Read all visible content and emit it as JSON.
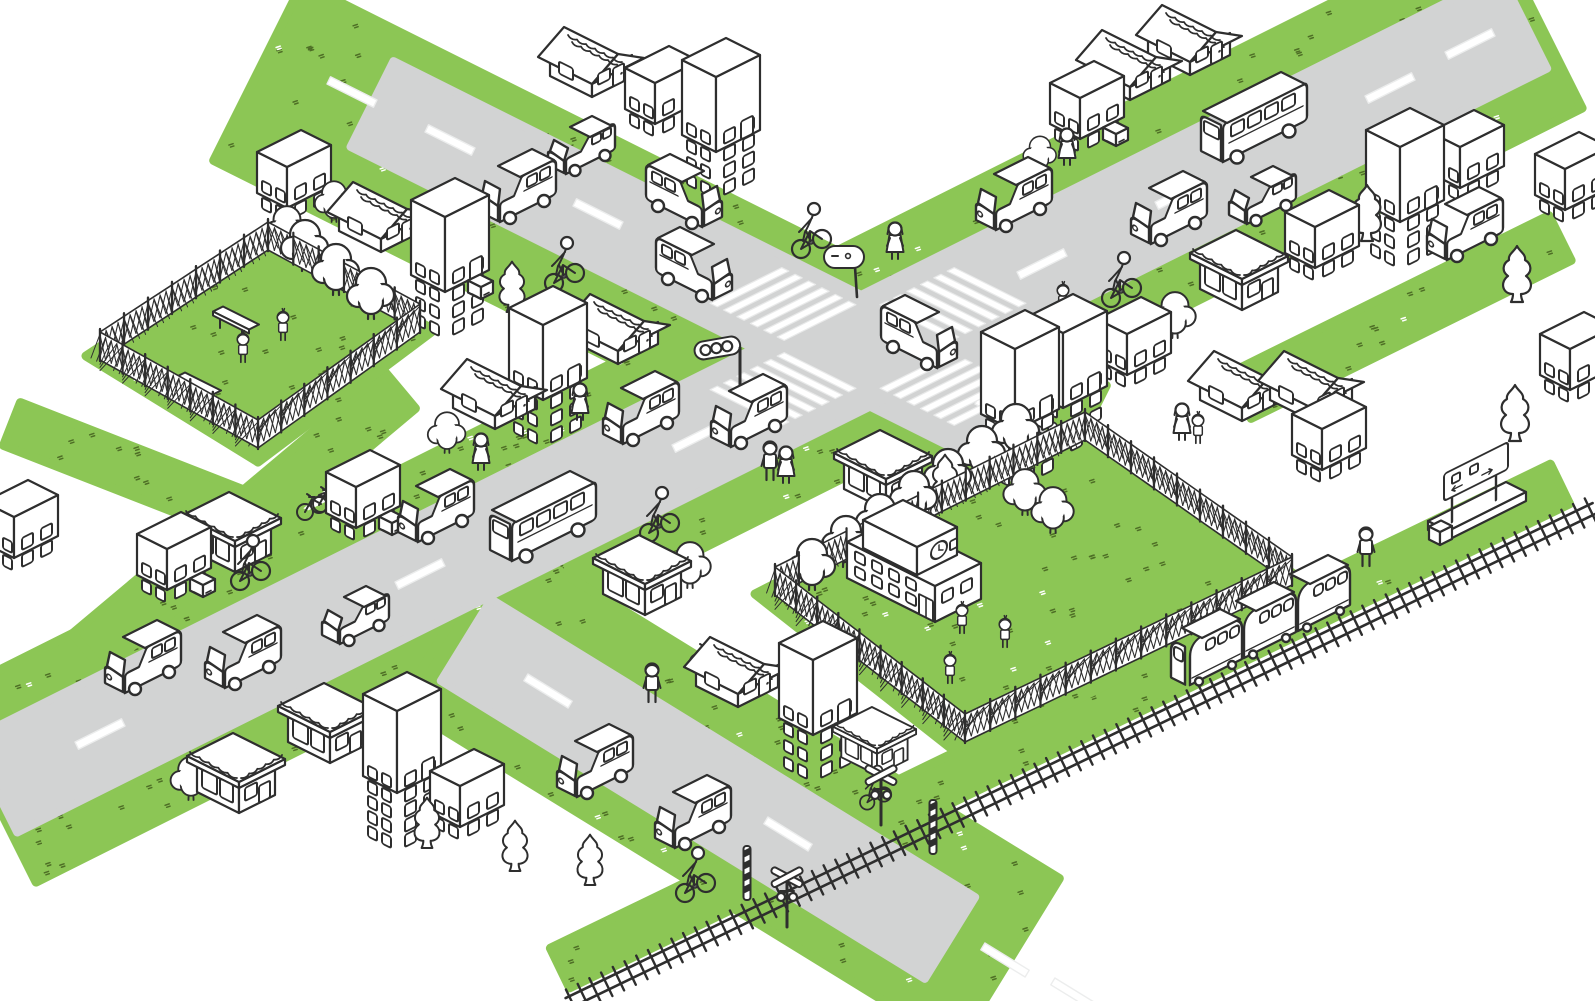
{
  "title": "isometric-town-illustration",
  "canvas": {
    "width": 1595,
    "height": 1001
  },
  "colors": {
    "grass": "#8cc655",
    "grass_speckle": "#4e6e26",
    "road": "#d2d3d3",
    "ink": "#2e2e2e",
    "white": "#ffffff"
  },
  "greens": [
    {
      "kind": "band",
      "name": "verge-road-nw",
      "from": [
        258,
        72
      ],
      "to": [
        1062,
        474
      ],
      "w": 198
    },
    {
      "kind": "band",
      "name": "verge-road-ne",
      "from": [
        1536,
        16
      ],
      "to": [
        -10,
        790
      ],
      "w": 206
    },
    {
      "kind": "band",
      "name": "verge-road-south",
      "from": [
        452,
        620
      ],
      "to": [
        1008,
        962
      ],
      "w": 196
    },
    {
      "kind": "band",
      "name": "sidewalk-strip-1",
      "from": [
        12,
        424
      ],
      "to": [
        452,
        596
      ],
      "w": 46
    },
    {
      "kind": "band",
      "name": "sidewalk-strip-2",
      "from": [
        88,
        652
      ],
      "to": [
        400,
        390
      ],
      "w": 48
    },
    {
      "kind": "band",
      "name": "sidewalk-strip-3",
      "from": [
        1240,
        396
      ],
      "to": [
        1560,
        238
      ],
      "w": 50
    },
    {
      "kind": "band",
      "name": "railway-verge",
      "from": [
        560,
        968
      ],
      "to": [
        1560,
        484
      ],
      "w": 44
    },
    {
      "kind": "poly",
      "name": "park-lawn",
      "pts": [
        [
          268,
          236
        ],
        [
          434,
          330
        ],
        [
          258,
          462
        ],
        [
          86,
          356
        ]
      ]
    },
    {
      "kind": "poly",
      "name": "schoolyard-lawn",
      "pts": [
        [
          1082,
          426
        ],
        [
          1308,
          584
        ],
        [
          962,
          757
        ],
        [
          755,
          594
        ]
      ]
    }
  ],
  "roads": [
    {
      "name": "road-northwest",
      "from": [
        372,
        104
      ],
      "to": [
        1038,
        437
      ],
      "w": 96
    },
    {
      "name": "road-northeast",
      "from": [
        1524,
        22
      ],
      "to": [
        -6,
        786
      ],
      "w": 104
    },
    {
      "name": "road-south",
      "from": [
        466,
        640
      ],
      "to": [
        950,
        938
      ],
      "w": 96
    }
  ],
  "dashes": [
    {
      "x": 352,
      "y": 92,
      "a": "u"
    },
    {
      "x": 450,
      "y": 140,
      "a": "u"
    },
    {
      "x": 598,
      "y": 214,
      "a": "u"
    },
    {
      "x": 1000,
      "y": 412,
      "a": "u"
    },
    {
      "x": 1470,
      "y": 44,
      "a": "v"
    },
    {
      "x": 1390,
      "y": 88,
      "a": "v"
    },
    {
      "x": 1180,
      "y": 194,
      "a": "v"
    },
    {
      "x": 1042,
      "y": 264,
      "a": "v"
    },
    {
      "x": 697,
      "y": 437,
      "a": "v"
    },
    {
      "x": 420,
      "y": 574,
      "a": "v"
    },
    {
      "x": 100,
      "y": 734,
      "a": "v"
    },
    {
      "x": 548,
      "y": 691,
      "a": "c"
    },
    {
      "x": 788,
      "y": 834,
      "a": "c"
    },
    {
      "x": 1005,
      "y": 960,
      "a": "c"
    },
    {
      "x": 1075,
      "y": 995,
      "a": "c"
    }
  ],
  "crosswalks": [
    {
      "x": 783,
      "y": 304,
      "a": "a"
    },
    {
      "x": 953,
      "y": 389,
      "a": "a"
    },
    {
      "x": 953,
      "y": 304,
      "a": "b"
    },
    {
      "x": 783,
      "y": 389,
      "a": "b"
    }
  ],
  "railway": {
    "from": [
      568,
      1003
    ],
    "to": [
      1595,
      508
    ]
  },
  "fences": [
    {
      "name": "park-fence",
      "h": 28,
      "pts": [
        [
          268,
          250
        ],
        [
          420,
          332
        ],
        [
          258,
          448
        ],
        [
          100,
          360
        ]
      ]
    },
    {
      "name": "schoolyard-fence",
      "h": 28,
      "pts": [
        [
          1085,
          440
        ],
        [
          1292,
          585
        ],
        [
          965,
          742
        ],
        [
          775,
          595
        ]
      ]
    }
  ],
  "objects": [
    {
      "t": "minivan",
      "x": 517,
      "y": 226,
      "o": "sw"
    },
    {
      "t": "car",
      "x": 581,
      "y": 178,
      "o": "sw"
    },
    {
      "t": "minivan",
      "x": 685,
      "y": 231,
      "o": "se"
    },
    {
      "t": "minivan",
      "x": 695,
      "y": 304,
      "o": "se"
    },
    {
      "t": "minivan",
      "x": 920,
      "y": 372,
      "o": "se"
    },
    {
      "t": "minivan",
      "x": 1013,
      "y": 234,
      "o": "sw"
    },
    {
      "t": "minivan",
      "x": 1168,
      "y": 248,
      "o": "sw"
    },
    {
      "t": "car",
      "x": 1262,
      "y": 228,
      "o": "sw"
    },
    {
      "t": "bus",
      "x": 1253,
      "y": 166,
      "o": "sw"
    },
    {
      "t": "minivan",
      "x": 1464,
      "y": 264,
      "o": "sw"
    },
    {
      "t": "minivan",
      "x": 748,
      "y": 451,
      "o": "sw"
    },
    {
      "t": "minivan",
      "x": 640,
      "y": 448,
      "o": "sw"
    },
    {
      "t": "minivan",
      "x": 435,
      "y": 546,
      "o": "sw"
    },
    {
      "t": "bus",
      "x": 542,
      "y": 565,
      "o": "sw"
    },
    {
      "t": "car",
      "x": 355,
      "y": 648,
      "o": "sw"
    },
    {
      "t": "minivan",
      "x": 242,
      "y": 692,
      "o": "sw"
    },
    {
      "t": "minivan",
      "x": 142,
      "y": 697,
      "o": "sw"
    },
    {
      "t": "minivan",
      "x": 594,
      "y": 801,
      "o": "sw"
    },
    {
      "t": "minivan",
      "x": 692,
      "y": 852,
      "o": "sw"
    },
    {
      "t": "train",
      "x": 1205,
      "y": 690
    },
    {
      "t": "building",
      "x": 287,
      "y": 208,
      "f": 2
    },
    {
      "t": "house",
      "x": 381,
      "y": 252
    },
    {
      "t": "building",
      "x": 445,
      "y": 292,
      "f": 4,
      "box": true
    },
    {
      "t": "house",
      "x": 592,
      "y": 97
    },
    {
      "t": "building",
      "x": 655,
      "y": 124,
      "f": 2
    },
    {
      "t": "building",
      "x": 716,
      "y": 152,
      "f": 4
    },
    {
      "t": "building",
      "x": 543,
      "y": 400,
      "f": 4
    },
    {
      "t": "house",
      "x": 618,
      "y": 364
    },
    {
      "t": "house",
      "x": 495,
      "y": 429
    },
    {
      "t": "building",
      "x": 167,
      "y": 590,
      "f": 2,
      "box": true
    },
    {
      "t": "shop",
      "x": 235,
      "y": 572
    },
    {
      "t": "building",
      "x": 356,
      "y": 528,
      "f": 2,
      "box": true
    },
    {
      "t": "building",
      "x": 14,
      "y": 558,
      "f": 2
    },
    {
      "t": "shop",
      "x": 239,
      "y": 813
    },
    {
      "t": "shop",
      "x": 330,
      "y": 763
    },
    {
      "t": "building",
      "x": 397,
      "y": 793,
      "f": 5
    },
    {
      "t": "building",
      "x": 460,
      "y": 827,
      "f": 2
    },
    {
      "t": "shop",
      "x": 645,
      "y": 615
    },
    {
      "t": "house",
      "x": 738,
      "y": 707
    },
    {
      "t": "building",
      "x": 813,
      "y": 735,
      "f": 4
    },
    {
      "t": "shop",
      "x": 877,
      "y": 775,
      "s": 0.85
    },
    {
      "t": "shop",
      "x": 886,
      "y": 510,
      "box": true
    },
    {
      "t": "school",
      "x": 935,
      "y": 622
    },
    {
      "t": "building",
      "x": 1015,
      "y": 431,
      "f": 5
    },
    {
      "t": "building",
      "x": 1063,
      "y": 408,
      "f": 4
    },
    {
      "t": "building",
      "x": 1127,
      "y": 375,
      "f": 2
    },
    {
      "t": "shop",
      "x": 1242,
      "y": 310
    },
    {
      "t": "building",
      "x": 1315,
      "y": 268,
      "f": 2
    },
    {
      "t": "house",
      "x": 1242,
      "y": 421
    },
    {
      "t": "house",
      "x": 1312,
      "y": 421
    },
    {
      "t": "building",
      "x": 1322,
      "y": 470,
      "f": 2
    },
    {
      "t": "house",
      "x": 1130,
      "y": 100
    },
    {
      "t": "house",
      "x": 1190,
      "y": 75
    },
    {
      "t": "building",
      "x": 1080,
      "y": 139,
      "f": 2,
      "box": true
    },
    {
      "t": "building",
      "x": 1400,
      "y": 222,
      "f": 4
    },
    {
      "t": "building",
      "x": 1460,
      "y": 188,
      "f": 2
    },
    {
      "t": "building",
      "x": 1565,
      "y": 210,
      "f": 2
    },
    {
      "t": "building",
      "x": 1570,
      "y": 390,
      "f": 2
    },
    {
      "t": "round-tree",
      "x": 334,
      "y": 222,
      "s": 0.8
    },
    {
      "t": "conifer-tree",
      "x": 512,
      "y": 312,
      "s": 0.9
    },
    {
      "t": "round-tree",
      "x": 447,
      "y": 453,
      "s": 0.8
    },
    {
      "t": "round-tree",
      "x": 287,
      "y": 252,
      "s": 0.9
    },
    {
      "t": "round-tree",
      "x": 305,
      "y": 271
    },
    {
      "t": "round-tree",
      "x": 336,
      "y": 295
    },
    {
      "t": "round-tree",
      "x": 371,
      "y": 319
    },
    {
      "t": "round-tree",
      "x": 191,
      "y": 800,
      "s": 0.85
    },
    {
      "t": "conifer-tree",
      "x": 427,
      "y": 848,
      "s": 0.9
    },
    {
      "t": "conifer-tree",
      "x": 515,
      "y": 871,
      "s": 0.9
    },
    {
      "t": "conifer-tree",
      "x": 590,
      "y": 885,
      "s": 0.9
    },
    {
      "t": "round-tree",
      "x": 690,
      "y": 588,
      "s": 0.9
    },
    {
      "t": "conifer-tree",
      "x": 945,
      "y": 505,
      "s": 0.9
    },
    {
      "t": "round-tree",
      "x": 812,
      "y": 590
    },
    {
      "t": "round-tree",
      "x": 846,
      "y": 567
    },
    {
      "t": "round-tree",
      "x": 880,
      "y": 545
    },
    {
      "t": "round-tree",
      "x": 914,
      "y": 522
    },
    {
      "t": "round-tree",
      "x": 948,
      "y": 500
    },
    {
      "t": "round-tree",
      "x": 982,
      "y": 477
    },
    {
      "t": "round-tree",
      "x": 1016,
      "y": 455
    },
    {
      "t": "round-tree",
      "x": 1025,
      "y": 515,
      "s": 0.9
    },
    {
      "t": "round-tree",
      "x": 1053,
      "y": 533,
      "s": 0.9
    },
    {
      "t": "round-tree",
      "x": 1175,
      "y": 338,
      "s": 0.9
    },
    {
      "t": "conifer-tree",
      "x": 1367,
      "y": 241
    },
    {
      "t": "conifer-tree",
      "x": 1517,
      "y": 302
    },
    {
      "t": "conifer-tree",
      "x": 1515,
      "y": 441
    },
    {
      "t": "round-tree",
      "x": 1040,
      "y": 172,
      "s": 0.7
    },
    {
      "t": "woman",
      "x": 580,
      "y": 421
    },
    {
      "t": "woman",
      "x": 481,
      "y": 471
    },
    {
      "t": "woman",
      "x": 895,
      "y": 260
    },
    {
      "t": "man",
      "x": 770,
      "y": 481
    },
    {
      "t": "woman",
      "x": 786,
      "y": 484
    },
    {
      "t": "man",
      "x": 652,
      "y": 703
    },
    {
      "t": "woman",
      "x": 1067,
      "y": 166
    },
    {
      "t": "child",
      "x": 1063,
      "y": 314
    },
    {
      "t": "woman",
      "x": 1182,
      "y": 441
    },
    {
      "t": "child",
      "x": 1198,
      "y": 444
    },
    {
      "t": "man",
      "x": 1366,
      "y": 567
    },
    {
      "t": "child",
      "x": 283,
      "y": 341
    },
    {
      "t": "child",
      "x": 243,
      "y": 363
    },
    {
      "t": "child",
      "x": 962,
      "y": 634
    },
    {
      "t": "child",
      "x": 1005,
      "y": 648
    },
    {
      "t": "child",
      "x": 950,
      "y": 684
    },
    {
      "t": "cyclist",
      "x": 565,
      "y": 290
    },
    {
      "t": "cyclist",
      "x": 812,
      "y": 256
    },
    {
      "t": "cyclist",
      "x": 1122,
      "y": 305
    },
    {
      "t": "cyclist",
      "x": 660,
      "y": 540
    },
    {
      "t": "cyclist",
      "x": 251,
      "y": 588
    },
    {
      "t": "cyclist",
      "x": 696,
      "y": 900
    },
    {
      "t": "cyclist",
      "x": 876,
      "y": 808,
      "s": 0.8
    },
    {
      "t": "parked-bicycle",
      "x": 305,
      "y": 512,
      "n": 2
    },
    {
      "t": "parked-bicycle",
      "x": 698,
      "y": 662,
      "n": 1
    },
    {
      "t": "bench",
      "x": 236,
      "y": 330
    },
    {
      "t": "bench",
      "x": 198,
      "y": 396
    },
    {
      "t": "traffic-light",
      "x": 740,
      "y": 390
    },
    {
      "t": "road-sign",
      "x": 862,
      "y": 297
    },
    {
      "t": "crossing-pole",
      "x": 747,
      "y": 900
    },
    {
      "t": "crossbuck",
      "x": 787,
      "y": 927
    },
    {
      "t": "crossbuck",
      "x": 881,
      "y": 825
    },
    {
      "t": "crossing-pole",
      "x": 933,
      "y": 854
    },
    {
      "t": "station",
      "x": 1448,
      "y": 540
    }
  ]
}
